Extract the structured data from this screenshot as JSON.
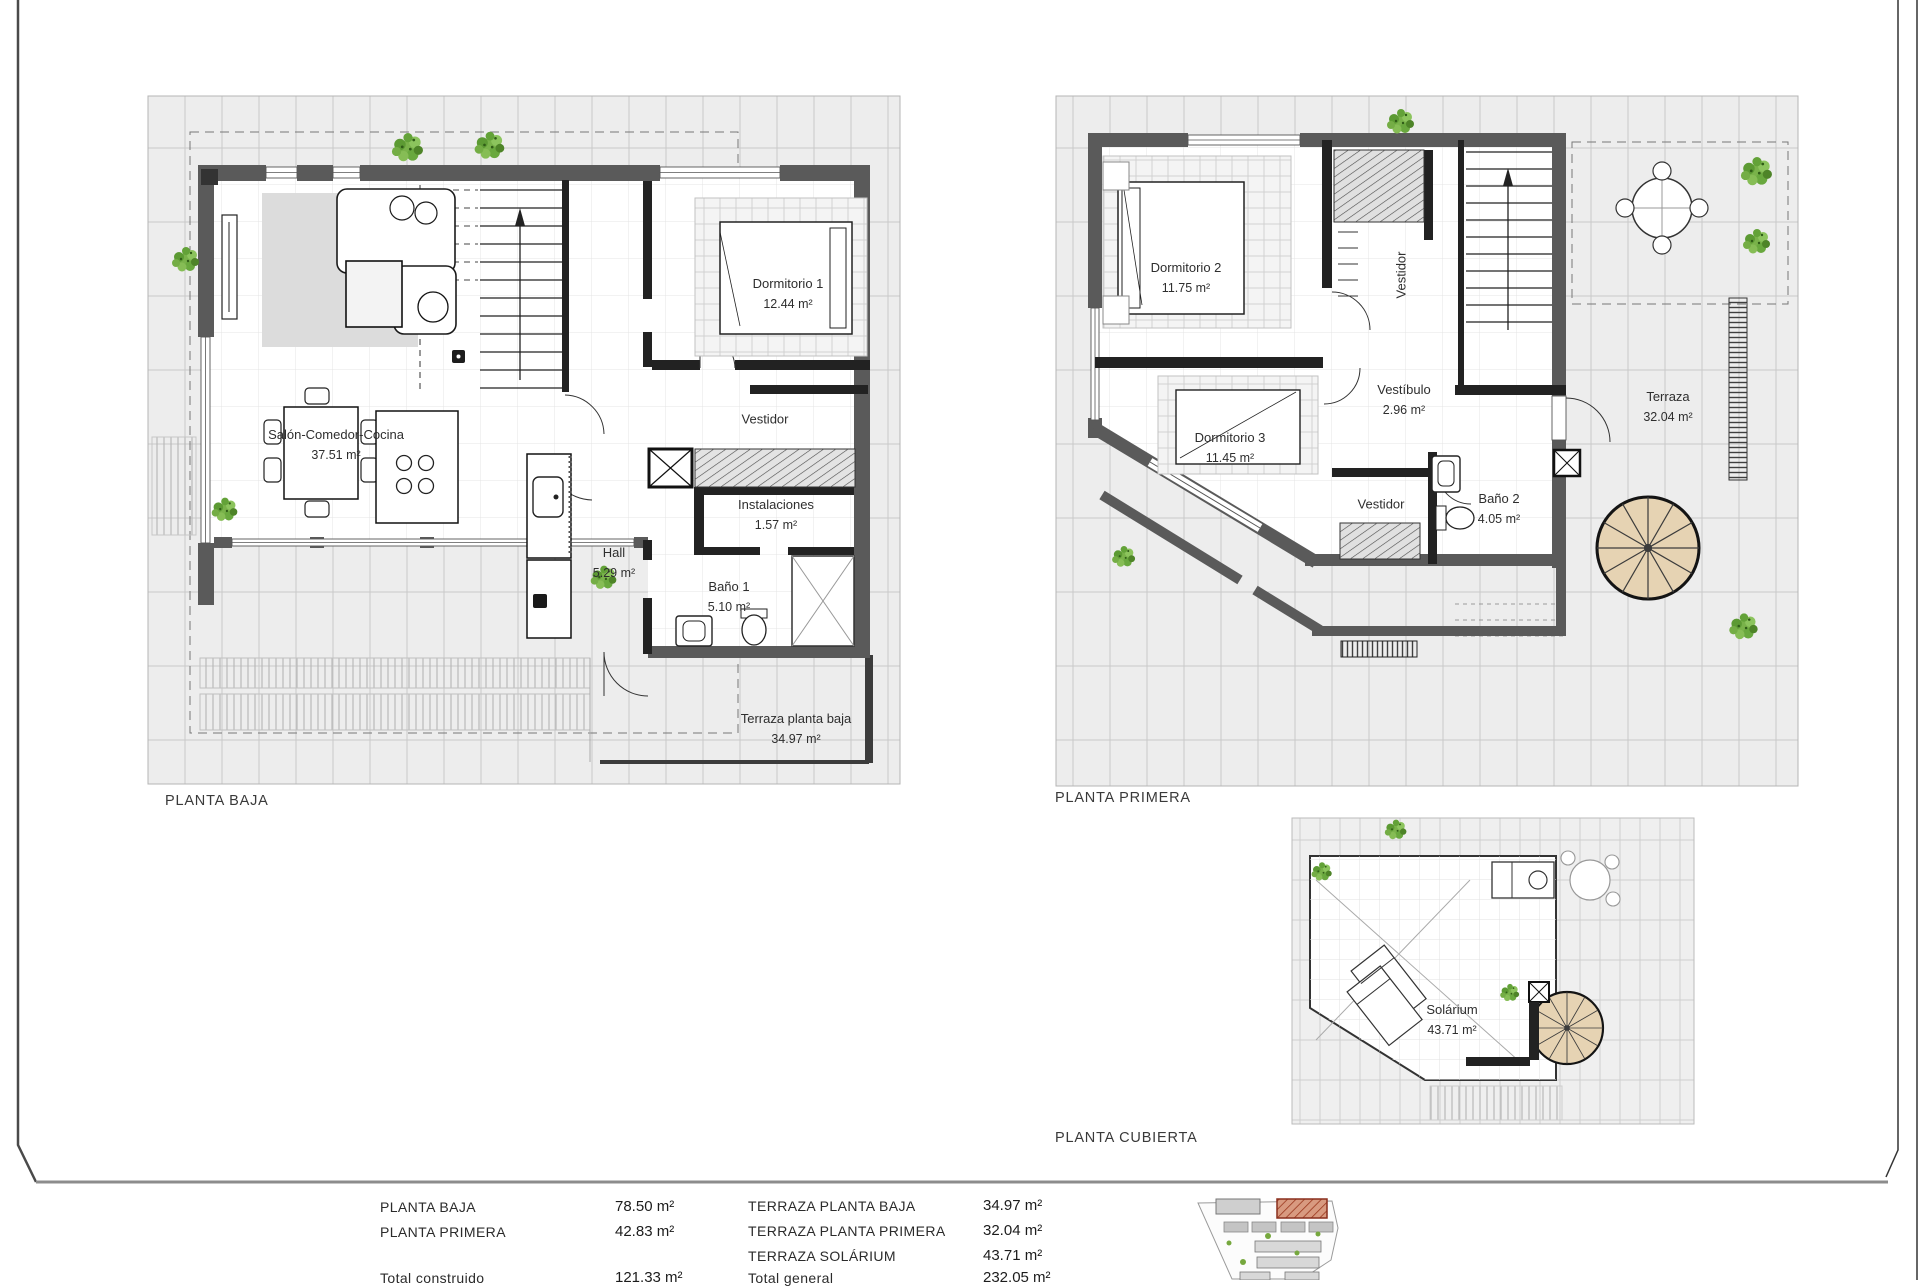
{
  "plans": {
    "ground": {
      "caption": "PLANTA BAJA",
      "rooms": {
        "salon": {
          "label": "Salón-Comedor-Cocina",
          "area": "37.51 m²"
        },
        "dormitorio1": {
          "label": "Dormitorio 1",
          "area": "12.44 m²"
        },
        "vestidor": {
          "label": "Vestidor"
        },
        "instalaciones": {
          "label": "Instalaciones",
          "area": "1.57 m²"
        },
        "hall": {
          "label": "Hall",
          "area": "5.29 m²"
        },
        "bano1": {
          "label": "Baño 1",
          "area": "5.10 m²"
        },
        "terraza": {
          "label": "Terraza planta baja",
          "area": "34.97 m²"
        }
      }
    },
    "first": {
      "caption": "PLANTA PRIMERA",
      "rooms": {
        "dormitorio2": {
          "label": "Dormitorio 2",
          "area": "11.75 m²"
        },
        "vestidor_norte": {
          "label": "Vestidor"
        },
        "vestibulo": {
          "label": "Vestíbulo",
          "area": "2.96 m²"
        },
        "dormitorio3": {
          "label": "Dormitorio 3",
          "area": "11.45 m²"
        },
        "vestidor_sur": {
          "label": "Vestidor"
        },
        "bano2": {
          "label": "Baño 2",
          "area": "4.05 m²"
        },
        "terraza": {
          "label": "Terraza",
          "area": "32.04 m²"
        }
      }
    },
    "roof": {
      "caption": "PLANTA CUBIERTA",
      "rooms": {
        "solarium": {
          "label": "Solárium",
          "area": "43.71 m²"
        }
      }
    }
  },
  "summary": {
    "left": [
      {
        "label": "PLANTA BAJA",
        "value": "78.50 m²"
      },
      {
        "label": "PLANTA PRIMERA",
        "value": "42.83 m²"
      },
      {
        "label": "Total construido",
        "value": "121.33 m²"
      }
    ],
    "right": [
      {
        "label": "TERRAZA PLANTA BAJA",
        "value": "34.97 m²"
      },
      {
        "label": "TERRAZA PLANTA PRIMERA",
        "value": "32.04 m²"
      },
      {
        "label": "TERRAZA SOLÁRIUM",
        "value": "43.71 m²"
      },
      {
        "label": "Total general",
        "value": "232.05 m²"
      }
    ]
  },
  "colors": {
    "wall_gray": "#5a5a5a",
    "partition_black": "#222222",
    "tile_line": "#c9c9c9",
    "plant_green": "#79b24a",
    "spiral_tan": "#e6d3b3",
    "site_highlight": "#9c3a20"
  }
}
